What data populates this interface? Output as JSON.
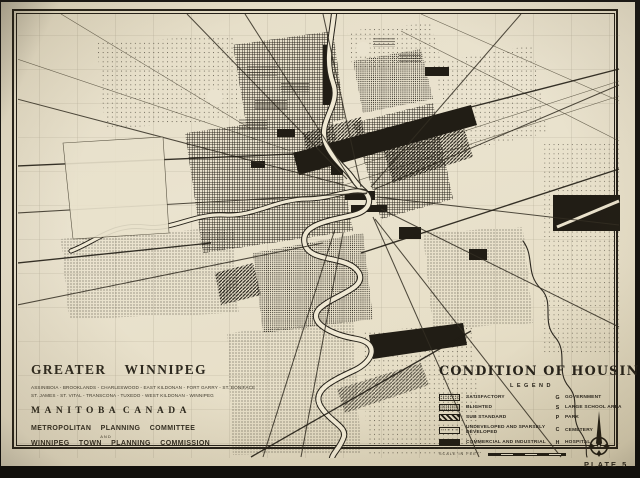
{
  "plate_label": "PLATE 5",
  "title_block": {
    "title": "GREATER WINNIPEG",
    "municipalities_line1": "ASSINIBOIA - BROOKLANDS - CHARLESWOOD - EAST KILDONAN - FORT GARRY - ST. BONIFACE",
    "municipalities_line2": "ST. JAMES - ST. VITAL - TRANSCONA - TUXEDO - WEST KILDONAN - WINNIPEG",
    "province": "MANITOBA",
    "country": "CANADA",
    "committee_line1": "METROPOLITAN PLANNING COMMITTEE",
    "committee_conjunction": "AND",
    "committee_line2": "WINNIPEG TOWN PLANNING COMMISSION"
  },
  "legend": {
    "title": "CONDITION OF HOUSING",
    "subtitle": "LEGEND",
    "items": [
      {
        "label": "SATISFACTORY",
        "swatch": "stipple-light"
      },
      {
        "label": "BLIGHTED",
        "swatch": "stipple-dense"
      },
      {
        "label": "SUB STANDARD",
        "swatch": "diagonal-hatch"
      },
      {
        "label": "UNDEVELOPED AND SPARSELY DEVELOPED",
        "swatch": "stipple-sparse"
      },
      {
        "label": "COMMERCIAL AND INDUSTRIAL",
        "swatch": "solid-black"
      }
    ],
    "symbols": [
      {
        "letter": "G",
        "label": "GOVERNMENT"
      },
      {
        "letter": "S",
        "label": "LARGE SCHOOL AREA"
      },
      {
        "letter": "P",
        "label": "PARK"
      },
      {
        "letter": "C",
        "label": "CEMETERY"
      },
      {
        "letter": "H",
        "label": "HOSPITAL"
      }
    ],
    "scale_label": "SCALE IN FEET"
  },
  "colors": {
    "paper": "#e9e1cb",
    "ink": "#211d15",
    "photo_background": "#141210"
  }
}
